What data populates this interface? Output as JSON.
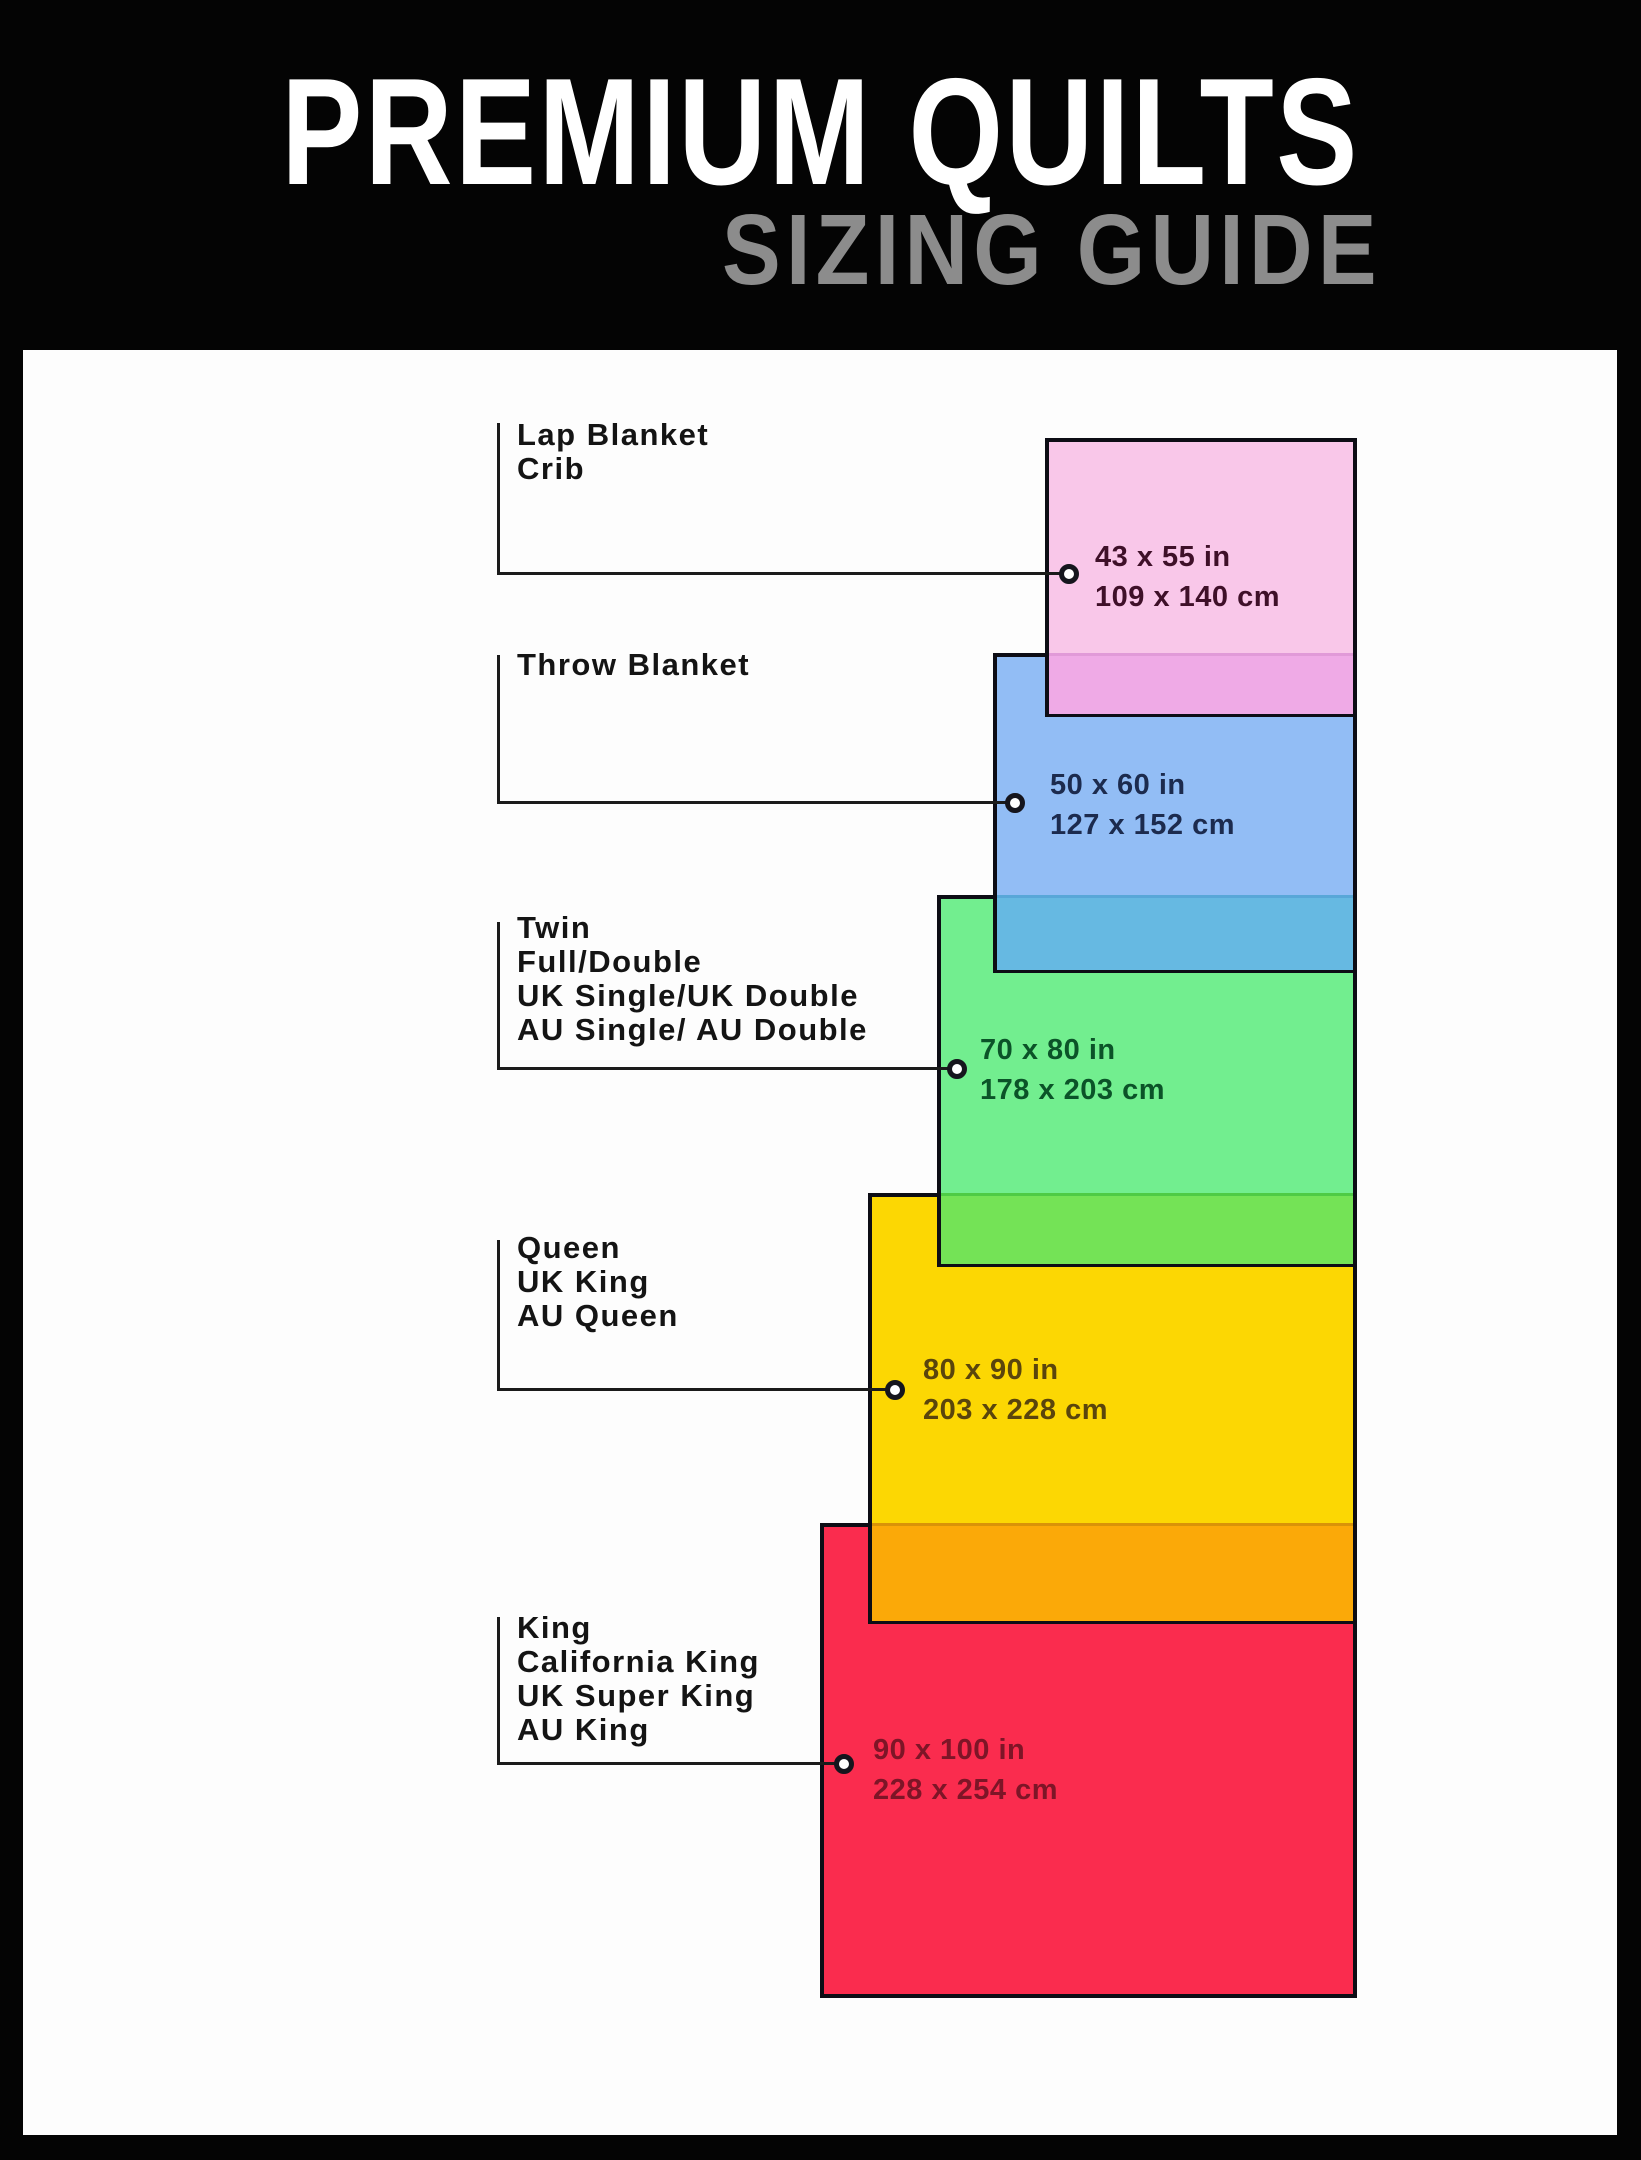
{
  "header": {
    "title": "PREMIUM QUILTS",
    "subtitle": "SIZING GUIDE"
  },
  "frame": {
    "background": "#040404",
    "content_background": "#fdfdfd",
    "border_color": "#0d0d15",
    "connector_color": "#1b1b1b"
  },
  "quilts": [
    {
      "id": "lap-blanket-crib",
      "labels": [
        "Lap Blanket",
        "Crib"
      ],
      "size_in": "43 x 55 in",
      "size_cm": "109 x 140 cm",
      "fill": "#f9c7e9",
      "overlap_fill": "#efaae6",
      "seam_color": "#e19ad8",
      "text_color": "#3f1029",
      "rect": {
        "left": 1045,
        "top": 438,
        "width": 312,
        "height": 279
      },
      "overlap": {
        "top": 653,
        "height": 61
      },
      "connector": {
        "x": 497,
        "top": 423,
        "line_y": 573,
        "circle_x": 1069
      },
      "label_pos": {
        "left": 517,
        "top": 418
      },
      "size_pos": {
        "left": 1095,
        "top": 537
      }
    },
    {
      "id": "throw-blanket",
      "labels": [
        "Throw Blanket"
      ],
      "size_in": "50 x 60 in",
      "size_cm": "127 x 152 cm",
      "fill": "#92bdf5",
      "overlap_fill": "#66b9e2",
      "seam_color": "#58a7d8",
      "text_color": "#1c2b4e",
      "rect": {
        "left": 993,
        "top": 653,
        "width": 364,
        "height": 320
      },
      "overlap": {
        "top": 895,
        "height": 75
      },
      "connector": {
        "x": 497,
        "top": 655,
        "line_y": 802,
        "circle_x": 1015
      },
      "label_pos": {
        "left": 517,
        "top": 648
      },
      "size_pos": {
        "left": 1050,
        "top": 765
      }
    },
    {
      "id": "twin-full-double",
      "labels": [
        "Twin",
        "Full/Double",
        "UK Single/UK Double",
        "AU Single/ AU Double"
      ],
      "size_in": "70 x 80 in",
      "size_cm": "178 x 203 cm",
      "fill": "#72ee8f",
      "overlap_fill": "#74e356",
      "seam_color": "#4ecb45",
      "text_color": "#0b5328",
      "rect": {
        "left": 937,
        "top": 895,
        "width": 420,
        "height": 372
      },
      "overlap": {
        "top": 1193,
        "height": 71
      },
      "connector": {
        "x": 497,
        "top": 922,
        "line_y": 1068,
        "circle_x": 957
      },
      "label_pos": {
        "left": 517,
        "top": 911
      },
      "size_pos": {
        "left": 980,
        "top": 1030
      }
    },
    {
      "id": "queen-uk-king",
      "labels": [
        "Queen",
        "UK King",
        "AU Queen"
      ],
      "size_in": "80 x 90 in",
      "size_cm": "203 x 228 cm",
      "fill": "#fcd703",
      "overlap_fill": "#fba908",
      "seam_color": "#d99308",
      "text_color": "#5a450c",
      "rect": {
        "left": 868,
        "top": 1193,
        "width": 489,
        "height": 431
      },
      "overlap": {
        "top": 1523,
        "height": 98
      },
      "connector": {
        "x": 497,
        "top": 1240,
        "line_y": 1389,
        "circle_x": 895
      },
      "label_pos": {
        "left": 517,
        "top": 1231
      },
      "size_pos": {
        "left": 923,
        "top": 1350
      }
    },
    {
      "id": "king-california-king",
      "labels": [
        "King",
        "California King",
        "UK Super King",
        "AU King"
      ],
      "size_in": "90 x 100 in",
      "size_cm": "228 x 254 cm",
      "fill": "#fa2c4e",
      "overlap_fill": null,
      "seam_color": null,
      "text_color": "#7d1527",
      "rect": {
        "left": 820,
        "top": 1523,
        "width": 537,
        "height": 475
      },
      "overlap": null,
      "connector": {
        "x": 497,
        "top": 1617,
        "line_y": 1763,
        "circle_x": 844
      },
      "label_pos": {
        "left": 517,
        "top": 1611
      },
      "size_pos": {
        "left": 873,
        "top": 1730
      }
    }
  ]
}
